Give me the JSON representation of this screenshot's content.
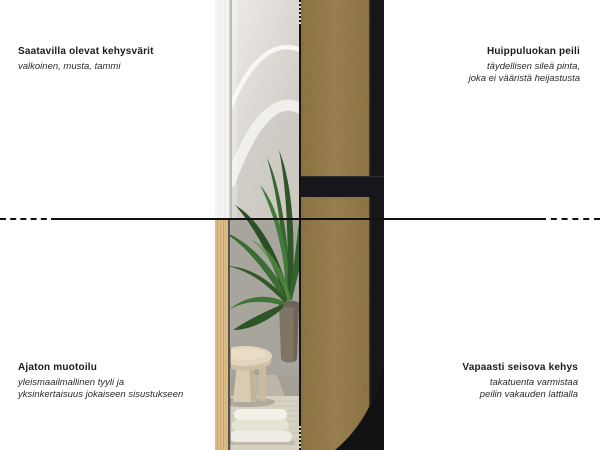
{
  "callouts": {
    "top_left": {
      "title": "Saatavilla olevat kehysvärit",
      "subtitle_lines": [
        "valkoinen, musta, tammi"
      ]
    },
    "top_right": {
      "title": "Huippuluokan peili",
      "subtitle_lines": [
        "täydellisen sileä pinta,",
        "joka ei vääristä heijastusta"
      ]
    },
    "bottom_left": {
      "title": "Ajaton muotoilu",
      "subtitle_lines": [
        "yleismaailmallinen tyyli ja",
        "yksinkertaisuus jokaiseen sisustukseen"
      ]
    },
    "bottom_right": {
      "title": "Vapaasti seisova kehys",
      "subtitle_lines": [
        "takatuenta varmistaa",
        "peilin vakauden lattialla"
      ]
    }
  },
  "colors": {
    "background": "#ffffff",
    "text": "#1b1b1b",
    "annotation_line": "#111111",
    "frame_black": "#17171a",
    "mdf_back_panel": "#b2935a",
    "oak_frame": "#ddbc85",
    "white_frame": "#f4f3f1",
    "plant_green": "#3c6a33"
  }
}
